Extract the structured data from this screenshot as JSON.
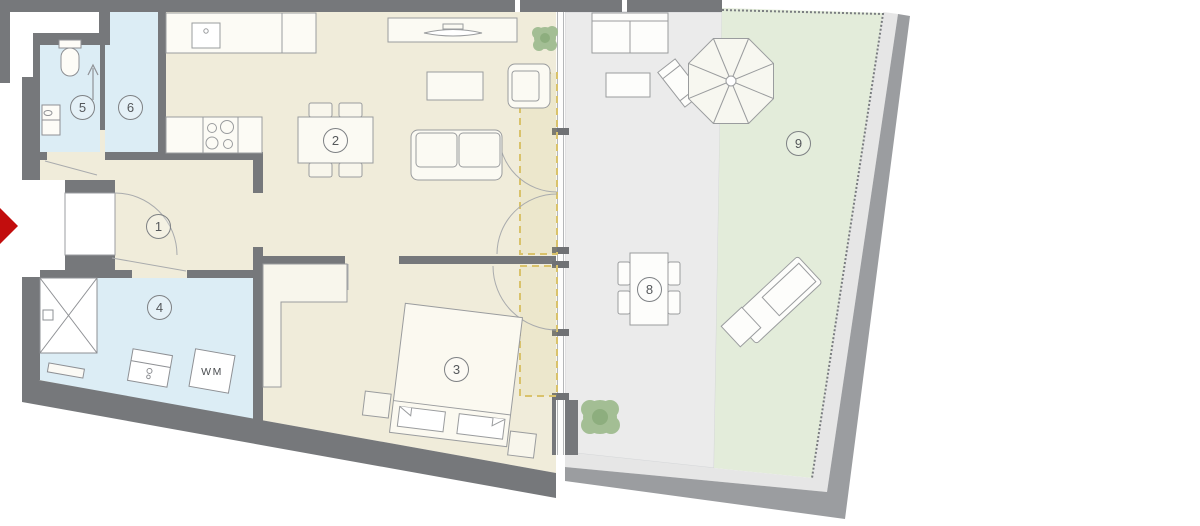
{
  "plan": {
    "rooms": [
      {
        "number": "1"
      },
      {
        "number": "2"
      },
      {
        "number": "3"
      },
      {
        "number": "4"
      },
      {
        "number": "5"
      },
      {
        "number": "6"
      },
      {
        "number": "8"
      },
      {
        "number": "9"
      }
    ],
    "appliance_label": "WM",
    "colors": {
      "wall": "#76787B",
      "outer_band": "#9B9DA0",
      "floor_main": "#F0ECDA",
      "floor_wet": "#DCEDF5",
      "terrace": "#EBEBEB",
      "garden": "#E3ECDA",
      "entry_arrow": "#C20D0D",
      "swing_zone": "#D9C26B",
      "furniture_stroke": "#8E9094",
      "plant": "#9CB88E"
    }
  }
}
